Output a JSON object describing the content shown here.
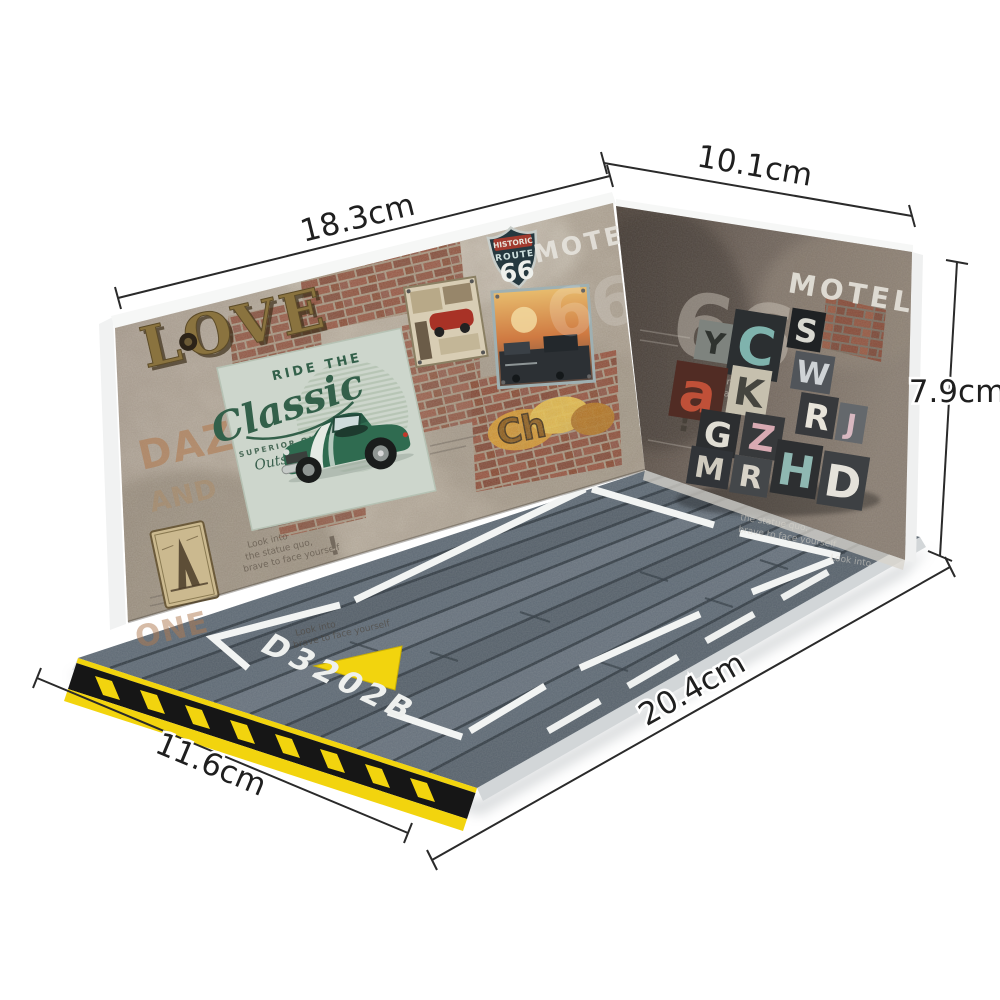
{
  "product_photo": {
    "description": "Diorama display base for model cars: two grunge brick walls and an asphalt parking floor, annotated with measurements",
    "dimensions": {
      "left_wall_width": "18.3cm",
      "right_wall_width": "10.1cm",
      "wall_height": "7.9cm",
      "floor_length": "20.4cm",
      "floor_depth": "11.6cm"
    },
    "left_wall": {
      "love_sign": "LOVE",
      "stencil_daze": "DAZE",
      "stencil_and": "AND",
      "stencil_one": "ONE",
      "motel_text": "MOTEL",
      "ghost_66": "66",
      "route_shield": {
        "historic": "HISTORIC",
        "route": "ROUTE",
        "number": "66"
      },
      "car_poster": {
        "ride_the": "RIDE THE",
        "classic": "Classic",
        "superior": "SUPERIOR QUALITY",
        "outstanding": "Outstanding"
      },
      "graffiti": "Ch",
      "exclamation": "!",
      "scribbles": [
        "Look into",
        "the statue quo,",
        "brave to face yourself"
      ]
    },
    "right_wall": {
      "ghost_66": "66",
      "motel_text": "MOTEL",
      "exclamation": "!",
      "scribbles": [
        "Look into",
        "the statue quo,",
        "brave to face yourself"
      ],
      "letterpress_letters": [
        {
          "ch": "Y",
          "block": "#7e837e",
          "ink": "#2f332f"
        },
        {
          "ch": "C",
          "block": "#2b2f31",
          "ink": "#7fb3ad"
        },
        {
          "ch": "S",
          "block": "#1f2224",
          "ink": "#d8d8d0"
        },
        {
          "ch": "W",
          "block": "#51555a",
          "ink": "#cfd3d6"
        },
        {
          "ch": "R",
          "block": "#37393c",
          "ink": "#e8e4da"
        },
        {
          "ch": "J",
          "block": "#64686c",
          "ink": "#d8b8c0"
        },
        {
          "ch": "a",
          "block": "#512c24",
          "ink": "#c05038"
        },
        {
          "ch": "K",
          "block": "#c6c0ae",
          "ink": "#45453f"
        },
        {
          "ch": "G",
          "block": "#2c2e30",
          "ink": "#e0ddd3"
        },
        {
          "ch": "Z",
          "block": "#37393b",
          "ink": "#d8aab2"
        },
        {
          "ch": "M",
          "block": "#313438",
          "ink": "#cfcabe"
        },
        {
          "ch": "R",
          "block": "#44474a",
          "ink": "#d8d3c8"
        },
        {
          "ch": "H",
          "block": "#2d2f31",
          "ink": "#8fb8b2"
        },
        {
          "ch": "D",
          "block": "#3d4043",
          "ink": "#e5e2da"
        }
      ]
    },
    "floor": {
      "space_id": "D3202B"
    },
    "colors": {
      "background": "#ffffff",
      "asphalt": "#5f6b76",
      "asphalt_seam": "#2e3840",
      "hazard_yellow": "#f2d40e",
      "hazard_black": "#161616",
      "parking_line_white": "#f2f4f3",
      "left_wall_plaster": "#b3a898",
      "right_wall_concrete": "#6e6258",
      "brick_red": "#8a4a36",
      "love_gold": "#8a733f",
      "poster_mint": "#cdd6cc",
      "poster_green": "#2f6b50",
      "shield_navy": "#25383f",
      "shield_red": "#a23a2e",
      "dimension_line": "#2a2a2a"
    }
  }
}
